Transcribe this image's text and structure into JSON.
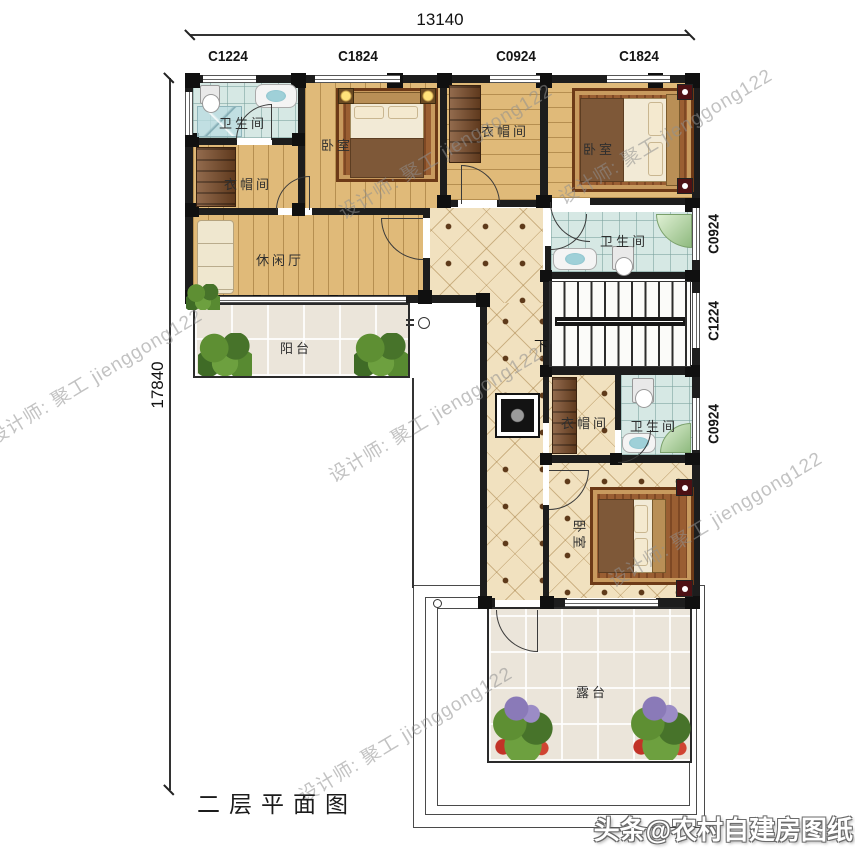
{
  "meta": {
    "title_label": "二层平面图"
  },
  "dimensions": {
    "top": "13140",
    "left": "17840"
  },
  "windows": {
    "top": [
      "C1224",
      "C1824",
      "C0924",
      "C1824"
    ],
    "right": [
      "C0924",
      "C1224",
      "C0924"
    ]
  },
  "rooms": {
    "bath_tl": "卫生间",
    "bed_tl": "卧室",
    "cloak_l": "衣帽间",
    "lounge": "休闲厅",
    "balcony": "阳台",
    "cloak_tm": "衣帽间",
    "bed_tr": "卧室",
    "bath_r": "卫生间",
    "cloak_m": "衣帽间",
    "bath_m": "卫生间",
    "bed_b": "卧室",
    "terrace": "露台"
  },
  "stairs": {
    "direction_label": "下"
  },
  "watermarks": {
    "designer": "设计师: 聚工 jienggong122",
    "brand": "头条@农村自建房图纸"
  },
  "colors": {
    "wall": "#1d1d1d",
    "wood_floor": "#e0ba79",
    "warm_tile": "#f1e1bf",
    "bath_tile": "#d6e8e4",
    "outdoor_tile": "#ebe5da",
    "wardrobe": "#7a4a26",
    "accent_red": "#4d1114",
    "plant_green": "#4e7d2c"
  }
}
